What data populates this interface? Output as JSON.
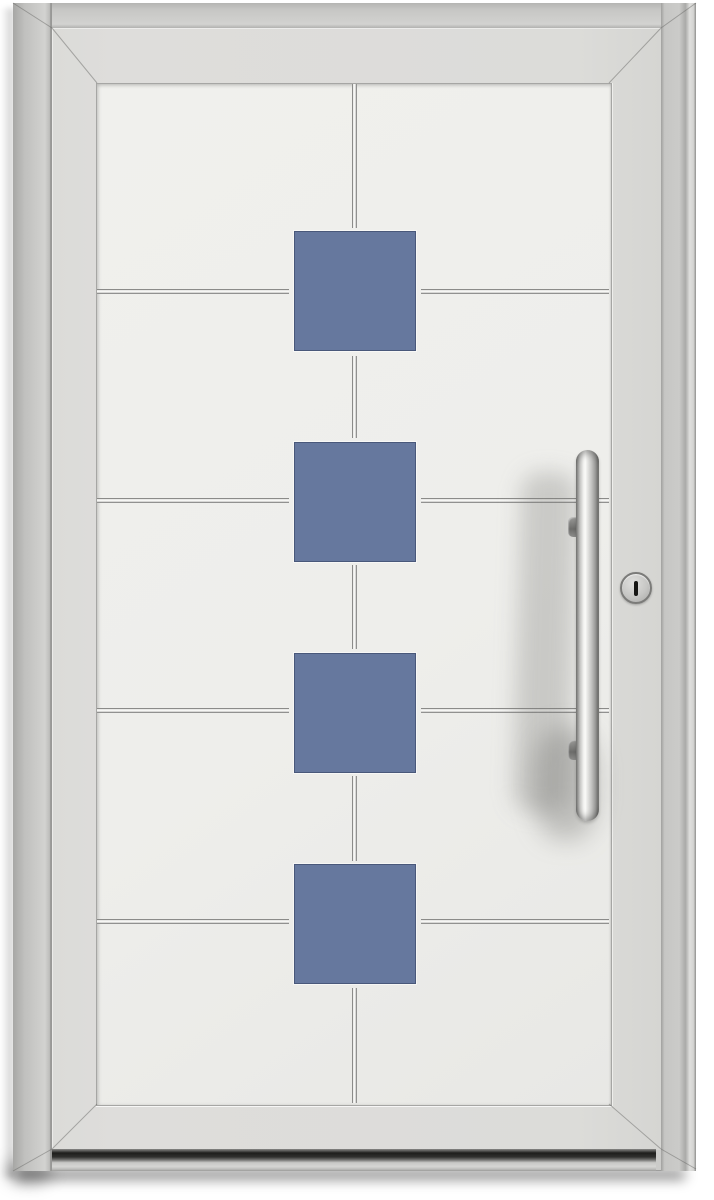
{
  "image_type": "product-render",
  "subject": "Modern entry door, white/light-grey aluminium, with four blue square accents on a centre line, stainless horizontal grooves, vertical stainless bar handle and profile-cylinder keyhole",
  "door": {
    "accent_squares": {
      "count": 4,
      "color_hex": "#66789e"
    },
    "horizontal_grooves": 4,
    "vertical_groove_segments": 5,
    "handle": "stainless vertical bar handle with two mounts",
    "lock": "round profile cylinder with vertical keyway",
    "frame": "light grey outer frame",
    "leaf": "off-white door leaf with recessed centre panel",
    "threshold": "dark recessed bottom threshold"
  },
  "colors": {
    "background": "#ffffff",
    "frame-base": "#cbcbc9",
    "leaf": "#dbdbd8",
    "panel-light": "#f0f0ed",
    "panel-dark": "#e8e8e5",
    "groove-light": "#f6f6f4",
    "groove-dark": "#8b8b89",
    "accent-blue": "#66789e",
    "accent-blue-edge": "#49587a",
    "steel-light": "#fbfbf9",
    "steel-dark": "#6f6f6d",
    "threshold-dark": "#1e1e1c",
    "lock-ring": "#7b7b79",
    "keyhole": "#161614"
  }
}
